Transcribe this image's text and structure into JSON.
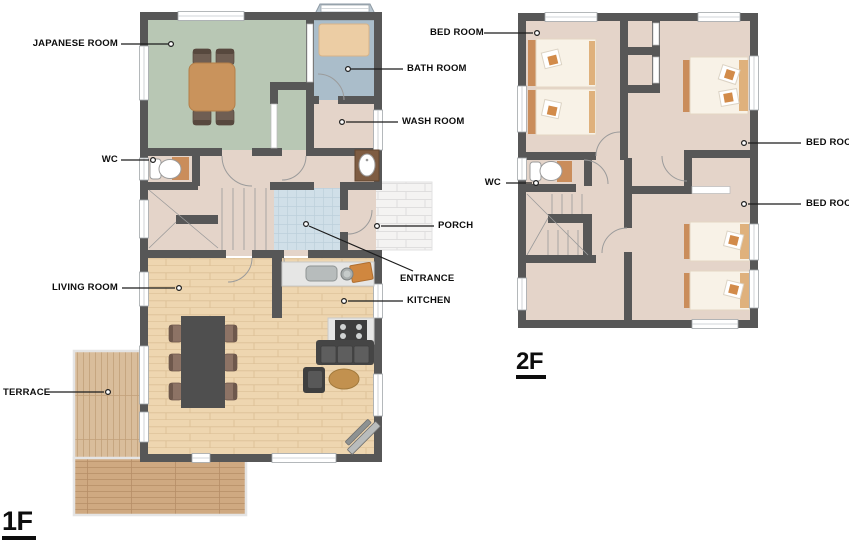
{
  "floor1": {
    "name": "1F",
    "labels": {
      "japanese_room": "JAPANESE ROOM",
      "bath_room": "BATH ROOM",
      "wash_room": "WASH ROOM",
      "wc": "WC",
      "porch": "PORCH",
      "entrance": "ENTRANCE",
      "kitchen": "KITCHEN",
      "living_room": "LIVING ROOM",
      "terrace": "TERRACE"
    }
  },
  "floor2": {
    "name": "2F",
    "labels": {
      "bed_room_top_left": "BED ROOM",
      "bed_room_right_upper": "BED ROOM",
      "bed_room_right_lower": "BED ROOM",
      "wc": "WC"
    }
  },
  "palette": {
    "wall": "#575757",
    "floor_beige": "#e4d4c9",
    "tatami_green": "#b8c7b4",
    "bath_blue": "#aabdca",
    "wood_floor": "#eed6b0",
    "deck_wood": "#d9bd9b",
    "entrance_tile": "#d0dfe8",
    "accent_tan": "#ca8d5b",
    "label_text": "#0d0d0d"
  }
}
